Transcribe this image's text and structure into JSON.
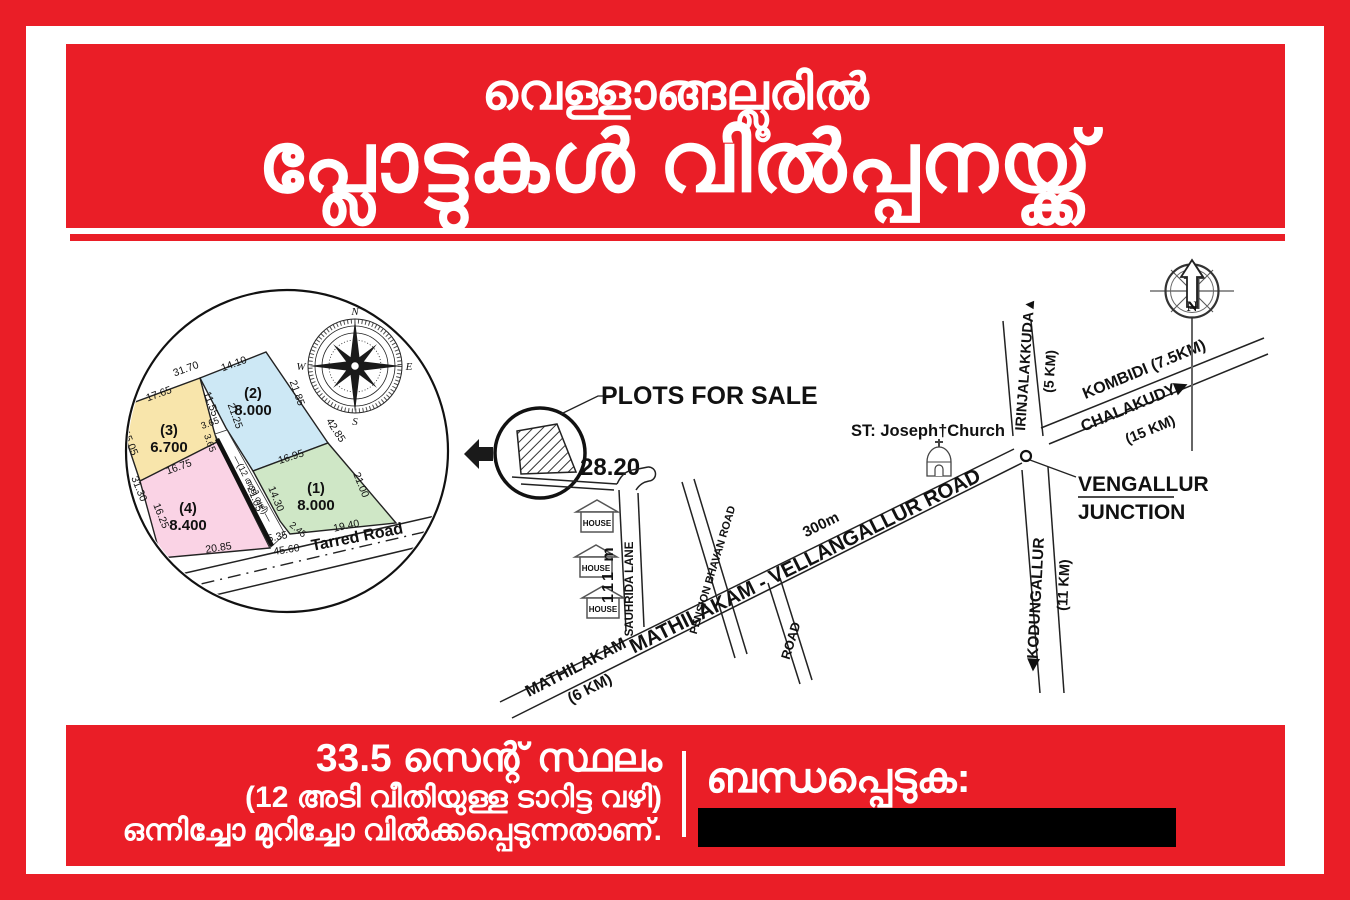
{
  "poster": {
    "accent_red": "#EA1E27",
    "header": {
      "line1": "വെള്ളാങ്ങല്ലൂരിൽ",
      "line2": "പ്ലോട്ടുകൾ വിൽപ്പനയ്ക്ക്"
    },
    "footer": {
      "area_line": "33.5 സെന്റ് സ്ഥലം",
      "road_line": "(12 അടി വീതിയുള്ള ടാറിട്ട വഴി)",
      "sale_line": "ഒന്നിച്ചോ മുറിച്ചോ വിൽക്കപ്പെടുന്നതാണ്.",
      "contact_label": "ബന്ധപ്പെടുക:"
    }
  },
  "map": {
    "labels": {
      "plots_for_sale": "PLOTS FOR SALE",
      "frontage": "28.20",
      "sauhrida_lane": "SAUHRIDA LANE",
      "lane_length": "111 m",
      "house": "HOUSE",
      "pension_bhavan_road": "PENSION BHAVAN ROAD",
      "main_road": "MATHILAKAM - VELLANGALLUR ROAD",
      "road_distance": "300m",
      "road_branch": "ROAD",
      "mathilakam": "MATHILAKAM",
      "mathilakam_dist": "(6 KM)",
      "church": "ST: Joseph†Church",
      "vengallur": "VENGALLUR",
      "junction": "JUNCTION",
      "irinjalakkuda": "IRINJALAKKUDA▲",
      "irinjalakkuda_dist": "(5 KM)",
      "kombidi": "KOMBIDI (7.5KM)",
      "chalakudy": "CHALAKUDY▶",
      "chalakudy_dist": "(15 KM)",
      "kodungallur": "◀KODUNGALLUR",
      "kodungallur_dist": "(11 KM)",
      "north": "N"
    },
    "compass": {
      "n": "N",
      "e": "E",
      "s": "S",
      "w": "W"
    },
    "inset": {
      "tarred_road": "Tarred Road",
      "lane_label": "—(12 അടി വഴി)—",
      "plots": [
        {
          "id": "(1)",
          "area": "8.000",
          "color": "#cfe7c6"
        },
        {
          "id": "(2)",
          "area": "8.000",
          "color": "#cde8f5"
        },
        {
          "id": "(3)",
          "area": "6.700",
          "color": "#f8e5ab"
        },
        {
          "id": "(4)",
          "area": "8.400",
          "color": "#fad3e5"
        }
      ],
      "m": {
        "v31_70": "31.70",
        "v17_65": "17.65",
        "v15_05": "15.05",
        "v31_30": "31.30",
        "v16_75": "16.75",
        "v14_10": "14.10",
        "v11_55": "11.55",
        "v21_25": "21.25",
        "v3_65a": "3.65",
        "v3_65b": "3.65",
        "v21_85": "21.85",
        "v42_85": "42.85",
        "v16_95": "16.95",
        "v14_30": "14.30",
        "v21_05": "21.05",
        "v21_00": "21.00",
        "v16_25": "16.25",
        "v19_40": "19.40",
        "v2_45": "2.45",
        "v5_35": "5.35",
        "v45_60": "45.60",
        "v20_85": "20.85"
      }
    }
  }
}
